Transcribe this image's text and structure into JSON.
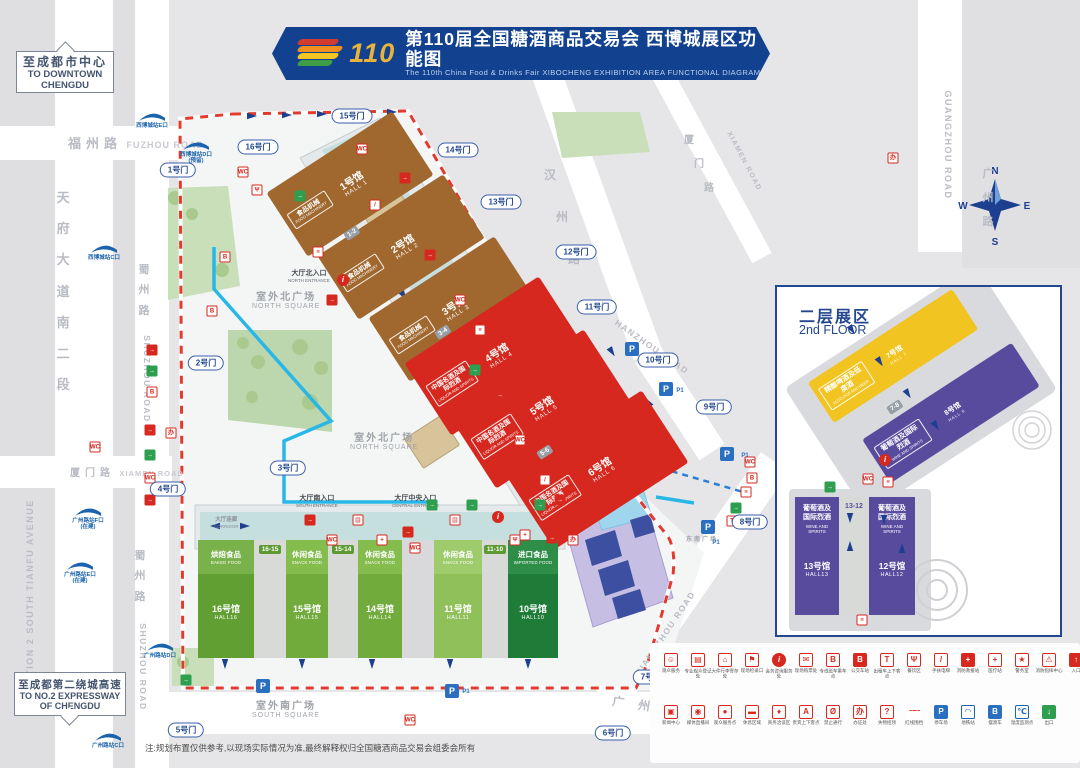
{
  "banner": {
    "logo_number": "110",
    "title_cn": "第110届全国糖酒商品交易会 西博城展区功能图",
    "title_en": "The 110th China Food & Drinks Fair  XIBOCHENG EXHIBITION AREA FUNCTIONAL DIAGRAM"
  },
  "signs": {
    "downtown_cn": "至成都市中心",
    "downtown_en": "TO DOWNTOWN CHENGDU",
    "expressway_cn": "至成都第二绕城高速",
    "expressway_en": "TO NO.2 EXPRESSWAY OF CHENGDU"
  },
  "roads": {
    "fuzhou_cn": "福州路",
    "fuzhou_en": "FUZHOU ROAD",
    "tianfu_cn": "天府大道南二段",
    "tianfu_en": "SECTION 2 SOUTH TIANFU AVENUE",
    "shuzhou_cn": "蜀州路",
    "shuzhou_en": "SHUZHOU ROAD",
    "xiamen_cn": "厦门路",
    "xiamen_en": "XIAMEN ROAD",
    "hanzhou_cn": "汉州路",
    "hanzhou_en": "HANZHOU ROAD",
    "guangzhou_cn": "广州路",
    "guangzhou_en": "GUANGZHOU ROAD"
  },
  "halls": [
    {
      "id": "1",
      "name_cn": "1号馆",
      "name_en": "HALL 1",
      "cat_cn": "食品机械",
      "cat_en": "FOOD MACHINERY",
      "color": "#a0682f"
    },
    {
      "id": "2",
      "name_cn": "2号馆",
      "name_en": "HALL 2",
      "cat_cn": "食品机械",
      "cat_en": "FOOD MACHINERY",
      "color": "#a0682f"
    },
    {
      "id": "3",
      "name_cn": "3号馆",
      "name_en": "HALL 3",
      "cat_cn": "食品机械",
      "cat_en": "FOOD MACHINERY",
      "color": "#a0682f"
    },
    {
      "id": "4",
      "name_cn": "4号馆",
      "name_en": "HALL 4",
      "cat_cn": "中国名酒及国际烈酒",
      "cat_en": "LIQUOR AND SPIRITS",
      "color": "#d6281f"
    },
    {
      "id": "5",
      "name_cn": "5号馆",
      "name_en": "HALL 5",
      "cat_cn": "中国名酒及国际烈酒",
      "cat_en": "LIQUOR AND SPIRITS",
      "color": "#d6281f"
    },
    {
      "id": "6",
      "name_cn": "6号馆",
      "name_en": "HALL 6",
      "cat_cn": "中国名酒及国际烈酒",
      "cat_en": "LIQUOR AND SPIRITS",
      "color": "#d6281f"
    },
    {
      "id": "7",
      "name_cn": "7号馆",
      "name_en": "HALL 7",
      "cat_cn": "精酿啤酒及低度酒",
      "cat_en": "ALCO-POP AND BEER",
      "color": "#f2c421"
    },
    {
      "id": "8",
      "name_cn": "8号馆",
      "name_en": "HALL 8",
      "cat_cn": "葡萄酒及国际烈酒",
      "cat_en": "WINE AND SPIRITS",
      "color": "#584b9e"
    },
    {
      "id": "10",
      "name_cn": "10号馆",
      "name_en": "HALL10",
      "cat_cn": "进口食品",
      "cat_en": "IMPORTED FOOD",
      "color": "#1e7c38",
      "band": "#2e8d47"
    },
    {
      "id": "11",
      "name_cn": "11号馆",
      "name_en": "HALL11",
      "cat_cn": "休闲食品",
      "cat_en": "SNACK FOOD",
      "color": "#8fc05a",
      "band": "#9ecb6b"
    },
    {
      "id": "12",
      "name_cn": "12号馆",
      "name_en": "HALL12",
      "cat_cn": "葡萄酒及国际烈酒",
      "cat_en": "WINE AND SPIRITS",
      "color": "#584b9e"
    },
    {
      "id": "13",
      "name_cn": "13号馆",
      "name_en": "HALL13",
      "cat_cn": "葡萄酒及国际烈酒",
      "cat_en": "WINE AND SPIRITS",
      "color": "#584b9e"
    },
    {
      "id": "14",
      "name_cn": "14号馆",
      "name_en": "HALL14",
      "cat_cn": "休闲食品",
      "cat_en": "SNACK FOOD",
      "color": "#70ab3c",
      "band": "#84bc4e"
    },
    {
      "id": "15",
      "name_cn": "15号馆",
      "name_en": "HALL15",
      "cat_cn": "休闲食品",
      "cat_en": "SNACK FOOD",
      "color": "#70ab3c",
      "band": "#84bc4e"
    },
    {
      "id": "16",
      "name_cn": "16号馆",
      "name_en": "HALL16",
      "cat_cn": "烘焙食品",
      "cat_en": "BAKED FOOD",
      "color": "#619f33",
      "band": "#79b24a"
    }
  ],
  "connectors": [
    "1-2",
    "3-4",
    "5-6",
    "7-8",
    "13-12",
    "16-15",
    "15-14",
    "11-10"
  ],
  "gates": [
    "1号门",
    "2号门",
    "3号门",
    "4号门",
    "5号门",
    "6号门",
    "7号门",
    "8号门",
    "9号门",
    "10号门",
    "11号门",
    "12号门",
    "13号门",
    "14号门",
    "15号门",
    "16号门"
  ],
  "metro_stations": [
    {
      "name": "西博城站E口",
      "status": ""
    },
    {
      "name": "西博城站D口",
      "status": "(预留)"
    },
    {
      "name": "西博城站C口",
      "status": ""
    },
    {
      "name": "广州路站F口",
      "status": "(在建)"
    },
    {
      "name": "广州路站E口",
      "status": "(在建)"
    },
    {
      "name": "广州路站D口",
      "status": ""
    },
    {
      "name": "广州路站C口",
      "status": ""
    }
  ],
  "places": {
    "north_square_cn": "室外北广场",
    "north_square_en": "NORTH SQUARE",
    "south_square_cn": "室外南广场",
    "south_square_en": "SOUTH SQUARE",
    "se_square_cn": "东南广场",
    "corridor_cn": "大厅连廊",
    "corridor_en": "CORRIDOR",
    "north_entrance_cn": "大厅北入口",
    "north_entrance_en": "NORTH ENTRANCE",
    "central_entrance_cn": "大厅中央入口",
    "central_entrance_en": "CENTRAL ENTRANCE",
    "south_entrance_cn": "大厅南入口",
    "south_entrance_en": "SOUTH ENTRANCE"
  },
  "inset": {
    "title_cn": "二层展区",
    "title_en": "2nd FLOOR"
  },
  "compass": {
    "n": "N",
    "e": "E",
    "s": "S",
    "w": "W"
  },
  "parking": {
    "label": "P",
    "sub": "P1"
  },
  "badge_char": "办",
  "legend": {
    "row1": [
      {
        "icon": "visitor-service-icon",
        "glyph": "☺",
        "label": "观众服务",
        "style": ""
      },
      {
        "icon": "registration-icon",
        "glyph": "▤",
        "label": "专业观众登记处",
        "style": ""
      },
      {
        "icon": "luggage-icon",
        "glyph": "⌂",
        "label": "大件行李寄存处",
        "style": ""
      },
      {
        "icon": "checkin-icon",
        "glyph": "⚑",
        "label": "现场检录口",
        "style": ""
      },
      {
        "icon": "info-icon",
        "glyph": "i",
        "label": "会务咨询服务处",
        "style": "circle-fill"
      },
      {
        "icon": "ticket-icon",
        "glyph": "✉",
        "label": "现场购票处",
        "style": ""
      },
      {
        "icon": "shuttle-bus-icon",
        "glyph": "B",
        "label": "专线班车乘车点",
        "style": ""
      },
      {
        "icon": "bus-stop-icon",
        "glyph": "B",
        "label": "公交车站",
        "style": "fill"
      },
      {
        "icon": "taxi-icon",
        "glyph": "T",
        "label": "出租车上下客点",
        "style": ""
      },
      {
        "icon": "dining-icon",
        "glyph": "Ψ",
        "label": "餐饮区",
        "style": ""
      },
      {
        "icon": "escalator-icon",
        "glyph": "/",
        "label": "手扶电梯",
        "style": ""
      },
      {
        "icon": "rescue-icon",
        "glyph": "+",
        "label": "消防救援站",
        "style": "fill"
      },
      {
        "icon": "medical-icon",
        "glyph": "+",
        "label": "医疗站",
        "style": ""
      },
      {
        "icon": "police-icon",
        "glyph": "★",
        "label": "警务室",
        "style": ""
      },
      {
        "icon": "fire-command-icon",
        "glyph": "⚠",
        "label": "消防指挥中心",
        "style": ""
      },
      {
        "icon": "entrance-icon",
        "glyph": "↑",
        "label": "入口",
        "style": "fill"
      }
    ],
    "row2": [
      {
        "icon": "press-center-icon",
        "glyph": "▣",
        "label": "新闻中心",
        "style": ""
      },
      {
        "icon": "live-studio-icon",
        "glyph": "◉",
        "label": "媒体直播间",
        "style": ""
      },
      {
        "icon": "service-point-icon",
        "glyph": "●",
        "label": "观众服务点",
        "style": ""
      },
      {
        "icon": "rest-area-icon",
        "glyph": "▬",
        "label": "休息区域",
        "style": ""
      },
      {
        "icon": "business-talk-icon",
        "glyph": "♦",
        "label": "商务洽谈区",
        "style": ""
      },
      {
        "icon": "vip-icon",
        "glyph": "A",
        "label": "贵宾上下客点",
        "style": ""
      },
      {
        "icon": "no-pass-icon",
        "glyph": "Ø",
        "label": "禁止通行",
        "style": ""
      },
      {
        "icon": "badge-office-icon",
        "glyph": "办",
        "label": "办证处",
        "style": ""
      },
      {
        "icon": "lost-found-icon",
        "glyph": "?",
        "label": "失物招领",
        "style": ""
      },
      {
        "icon": "red-fence-icon",
        "glyph": "╌╌",
        "label": "红线围挡",
        "style": "dash"
      },
      {
        "icon": "parking-icon",
        "glyph": "P",
        "label": "停车场",
        "style": "bluefill"
      },
      {
        "icon": "metro-icon",
        "glyph": "◠",
        "label": "地铁站",
        "style": "blue"
      },
      {
        "icon": "ferry-bus-icon",
        "glyph": "B",
        "label": "摆渡车",
        "style": "bluefill"
      },
      {
        "icon": "temperature-icon",
        "glyph": "℃",
        "label": "温度监测点",
        "style": "blue"
      },
      {
        "icon": "exit-icon",
        "glyph": "↓",
        "label": "出口",
        "style": "greenfill"
      }
    ]
  },
  "note": "注:规划布置仅供参考,以现场实际情况为准,最终解释权归全国糖酒商品交易会组委会所有"
}
